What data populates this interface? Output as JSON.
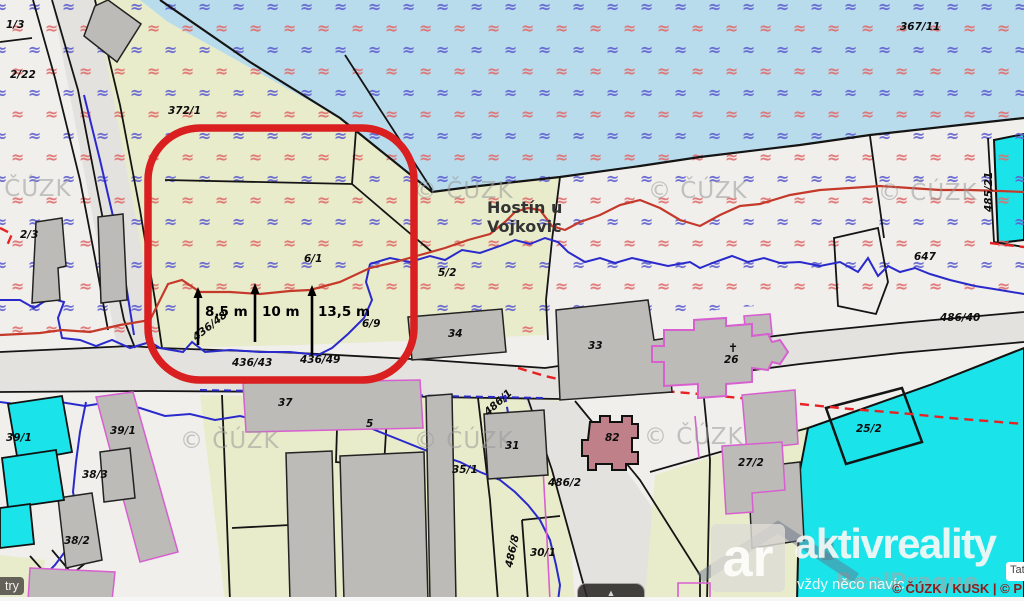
{
  "annotations": {
    "place": {
      "line1": "Hostín u",
      "line2": "Vojkovic"
    },
    "measurements": [
      {
        "label": "8,5 m",
        "x": 198,
        "y1": 345,
        "y2": 288,
        "lx": 205,
        "ly": 316
      },
      {
        "label": "10 m",
        "x": 255,
        "y1": 342,
        "y2": 284,
        "lx": 262,
        "ly": 316
      },
      {
        "label": "13,5 m",
        "x": 312,
        "y1": 355,
        "y2": 286,
        "lx": 318,
        "ly": 316
      }
    ]
  },
  "parcels": [
    {
      "t": "1/3",
      "x": 6,
      "y": 28
    },
    {
      "t": "2/22",
      "x": 10,
      "y": 78
    },
    {
      "t": "372/1",
      "x": 168,
      "y": 114
    },
    {
      "t": "367/11",
      "x": 900,
      "y": 30
    },
    {
      "t": "2/3",
      "x": 20,
      "y": 238
    },
    {
      "t": "6/1",
      "x": 304,
      "y": 262
    },
    {
      "t": "5/2",
      "x": 438,
      "y": 276
    },
    {
      "t": "6/9",
      "x": 362,
      "y": 327
    },
    {
      "t": "436/48",
      "x": 196,
      "y": 341,
      "r": -38
    },
    {
      "t": "436/43",
      "x": 232,
      "y": 366
    },
    {
      "t": "436/49",
      "x": 300,
      "y": 363
    },
    {
      "t": "34",
      "x": 448,
      "y": 337
    },
    {
      "t": "33",
      "x": 588,
      "y": 349
    },
    {
      "t": "37",
      "x": 278,
      "y": 406
    },
    {
      "t": "5",
      "x": 366,
      "y": 427
    },
    {
      "t": "647",
      "x": 914,
      "y": 260
    },
    {
      "t": "486/40",
      "x": 940,
      "y": 321
    },
    {
      "t": "485/21",
      "x": 992,
      "y": 212,
      "r": -90
    },
    {
      "t": "39/1",
      "x": 6,
      "y": 441
    },
    {
      "t": "39/1",
      "x": 110,
      "y": 434
    },
    {
      "t": "38/3",
      "x": 82,
      "y": 478
    },
    {
      "t": "38/2",
      "x": 64,
      "y": 544
    },
    {
      "t": "31",
      "x": 505,
      "y": 449
    },
    {
      "t": "35/1",
      "x": 452,
      "y": 473
    },
    {
      "t": "486/1",
      "x": 488,
      "y": 416,
      "r": -42
    },
    {
      "t": "486/2",
      "x": 548,
      "y": 486
    },
    {
      "t": "82",
      "x": 605,
      "y": 441
    },
    {
      "t": "✝",
      "x": 728,
      "y": 352,
      "fs": 12
    },
    {
      "t": "26",
      "x": 724,
      "y": 363
    },
    {
      "t": "27/2",
      "x": 738,
      "y": 466
    },
    {
      "t": "25/2",
      "x": 856,
      "y": 432
    },
    {
      "t": "30/1",
      "x": 530,
      "y": 556
    },
    {
      "t": "486/8",
      "x": 512,
      "y": 568,
      "r": -78
    }
  ],
  "watermark": {
    "text": "© ČÚZK",
    "positions": [
      [
        -28,
        196
      ],
      [
        414,
        198
      ],
      [
        648,
        198
      ],
      [
        878,
        200
      ],
      [
        180,
        448
      ],
      [
        414,
        448
      ],
      [
        644,
        444
      ]
    ],
    "brand": "RealPrague",
    "brand_x": 836,
    "brand_y": 589
  },
  "logo": {
    "monogram": "ar",
    "name": "aktivreality",
    "tagline": "vždy něco navíc"
  },
  "footer": {
    "attribution": "© ČÚZK / KUSK | © P",
    "info_chip": "Tat",
    "scale_chip": "try",
    "panel_toggle": "▲"
  },
  "map_symbols": {
    "wave": "≈"
  },
  "colors": {
    "water": "#b9dcec",
    "land": "#e9ecca",
    "road": "#e3e2de",
    "parcel_white": "#f0efeb",
    "building": "#bcbbb7",
    "cyan": "#1ae4ea",
    "church_pink": "#c08089",
    "wave_blue": "#6262d0",
    "wave_red": "#e06e6e",
    "highlight": "#d91f1f",
    "stream_blue": "#2a2acc",
    "contour_red": "#c4392a",
    "boundary_magenta": "#d75fd0",
    "attribution_red": "#8e1b1b"
  }
}
